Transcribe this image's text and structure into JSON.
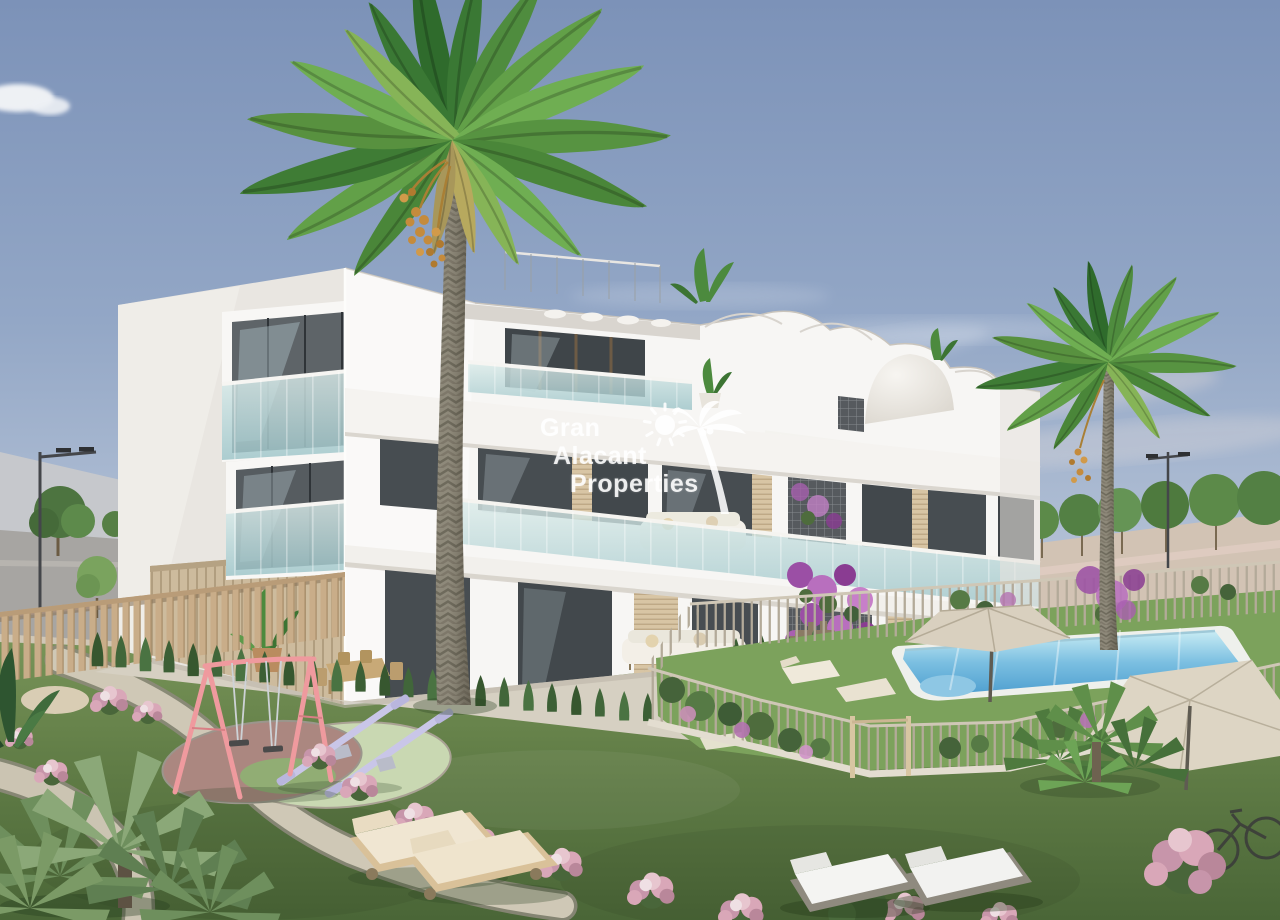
{
  "image": {
    "kind": "architectural exterior render",
    "subject": "three-storey white apartment building with garden, playground, palm trees and swimming pool"
  },
  "watermark": {
    "line1": "Gran",
    "line2": "Alacant",
    "line3": "Properties",
    "color": "#ffffff",
    "icons": [
      "sun-icon",
      "palm-tree-icon"
    ]
  },
  "palette": {
    "sky_top": "#7c92b8",
    "sky_horizon": "#d9dce2",
    "facade_white": "#f7f6f4",
    "facade_shade": "#e9e6e1",
    "glass_teal": "#aecfd2",
    "wood_beige": "#c9b79c",
    "grass_green": "#5d7a44",
    "path_gravel": "#cfc8b6",
    "pool_blue": "#5fb0dd",
    "hedge_green": "#3a5a33",
    "flower_pink": "#d9a7b8",
    "bougainvillea_purple": "#a050a8",
    "swing_pink": "#ef9a9e",
    "seesaw_lilac": "#c9c6e8",
    "parasol_beige": "#d9d0bf",
    "palm_trunk_gray": "#8d897b",
    "watermark_white": "#ffffff"
  }
}
